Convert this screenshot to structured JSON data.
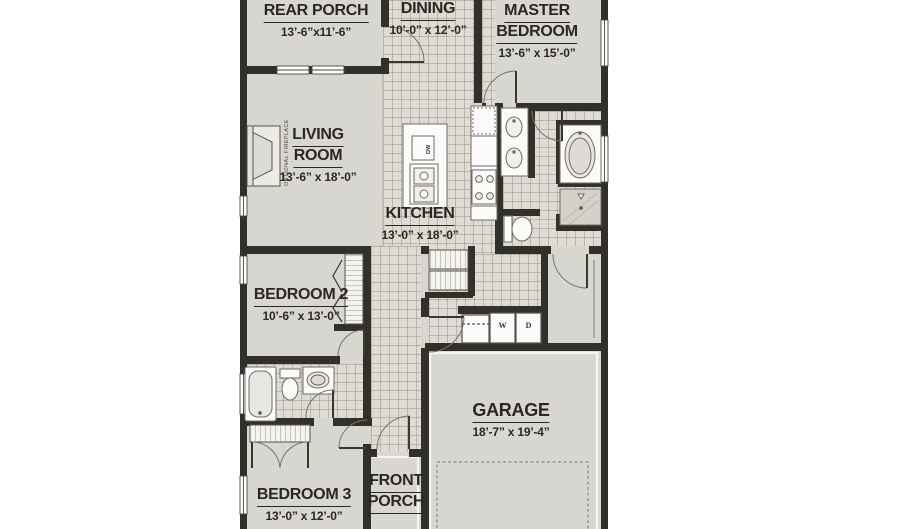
{
  "rooms": {
    "rear_porch": {
      "name": "REAR PORCH",
      "dims": "13’-6”x11’-6”"
    },
    "dining": {
      "name": "DINING",
      "dims": "10’-0” x 12’-0”"
    },
    "master_bedroom": {
      "line1": "MASTER",
      "line2": "BEDROOM",
      "dims": "13’-6” x 15’-0”"
    },
    "living_room": {
      "line1": "LIVING",
      "line2": "ROOM",
      "dims": "13’-6” x 18’-0”"
    },
    "kitchen": {
      "name": "KITCHEN",
      "dims": "13’-0” x 18’-0”"
    },
    "bedroom2": {
      "name": "BEDROOM 2",
      "dims": "10’-6” x 13’-0”"
    },
    "garage": {
      "name": "GARAGE",
      "dims": "18’-7” x 19’-4”"
    },
    "bedroom3": {
      "name": "BEDROOM 3",
      "dims": "13’-0” x 12’-0”"
    },
    "front_porch": {
      "line1": "FRONT",
      "line2": "PORCH"
    }
  },
  "fixtures": {
    "washer": "W",
    "dryer": "D",
    "dishwasher": "DW",
    "fireplace_note": "OPTIONAL FIREPLACE"
  },
  "colors": {
    "background": "#ffffff",
    "floor": "#d8d6d0",
    "tile": "#dddbd4",
    "wall": "#32302b",
    "fixture": "#fbfbf9",
    "text": "#2b2722"
  }
}
